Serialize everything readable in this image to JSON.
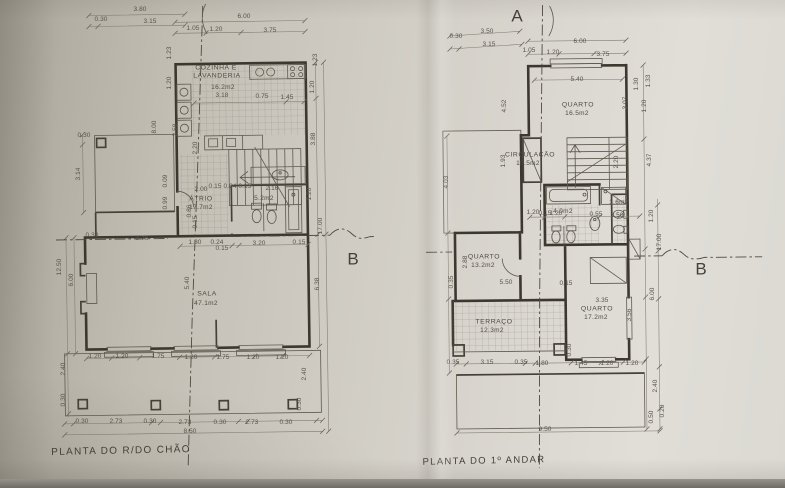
{
  "colors": {
    "paper": "#d3d0c8",
    "ink": "#4a463f"
  },
  "section_markers": [
    {
      "t": "A",
      "x": 517,
      "y": 16,
      "cls": "marker"
    },
    {
      "t": "B",
      "x": 353,
      "y": 259,
      "cls": "marker"
    },
    {
      "t": "B",
      "x": 701,
      "y": 269,
      "cls": "marker"
    }
  ],
  "ground_floor": {
    "title": "PLANTA DO R/DO CHÃO",
    "annotations": [
      {
        "t": "3.80",
        "x": 140,
        "y": 10
      },
      {
        "t": "0.30",
        "x": 101,
        "y": 20
      },
      {
        "t": "3.15",
        "x": 150,
        "y": 22
      },
      {
        "t": "6.00",
        "x": 244,
        "y": 17
      },
      {
        "t": "1.05",
        "x": 193,
        "y": 29
      },
      {
        "t": "1.20",
        "x": 216,
        "y": 30
      },
      {
        "t": "3.75",
        "x": 270,
        "y": 31
      },
      {
        "t": "1.23",
        "x": 170,
        "y": 53,
        "r": -90
      },
      {
        "t": "1.20",
        "x": 170,
        "y": 83,
        "r": -90
      },
      {
        "t": "8.00",
        "x": 155,
        "y": 127,
        "r": -90
      },
      {
        "t": "3.58",
        "x": 176,
        "y": 130,
        "r": -90
      },
      {
        "t": "2.20",
        "x": 196,
        "y": 148,
        "r": -90
      },
      {
        "t": "0.30",
        "x": 84,
        "y": 136
      },
      {
        "t": "3.14",
        "x": 79,
        "y": 174,
        "r": -90
      },
      {
        "t": "0.09",
        "x": 166,
        "y": 181,
        "r": -90
      },
      {
        "t": "0.99",
        "x": 166,
        "y": 203,
        "r": -90
      },
      {
        "t": "12.50",
        "x": 60,
        "y": 267,
        "r": -90
      },
      {
        "t": "6.00",
        "x": 72,
        "y": 280,
        "r": -90
      },
      {
        "t": "0.30",
        "x": 92,
        "y": 236
      },
      {
        "t": "3.76",
        "x": 142,
        "y": 239
      },
      {
        "t": "1.23",
        "x": 316,
        "y": 60,
        "r": -90
      },
      {
        "t": "1.20",
        "x": 313,
        "y": 87,
        "r": -90
      },
      {
        "t": "3.88",
        "x": 314,
        "y": 139,
        "r": -90
      },
      {
        "t": "1.20",
        "x": 310,
        "y": 194,
        "r": -90
      },
      {
        "t": "17.00",
        "x": 321,
        "y": 226,
        "r": -90
      },
      {
        "t": "6.38",
        "x": 318,
        "y": 284,
        "r": -90
      },
      {
        "t": "COZINHA E",
        "x": 216,
        "y": 69,
        "cls": "room"
      },
      {
        "t": "LAVANDERIA",
        "x": 217,
        "y": 77,
        "cls": "room"
      },
      {
        "t": "16.2m2",
        "x": 223,
        "y": 88,
        "cls": "area"
      },
      {
        "t": "3.18",
        "x": 222,
        "y": 96
      },
      {
        "t": "0.75",
        "x": 262,
        "y": 97
      },
      {
        "t": "1.45",
        "x": 287,
        "y": 98
      },
      {
        "t": "2.00",
        "x": 201,
        "y": 190
      },
      {
        "t": "ÁTRIO",
        "x": 201,
        "y": 200,
        "cls": "room"
      },
      {
        "t": "17.7m2",
        "x": 201,
        "y": 208,
        "cls": "area"
      },
      {
        "t": "0.15 0.84 0.15",
        "x": 230,
        "y": 187
      },
      {
        "t": "2.16",
        "x": 272,
        "y": 189
      },
      {
        "t": "5.2m2",
        "x": 264,
        "y": 199,
        "cls": "area"
      },
      {
        "t": "0.86",
        "x": 190,
        "y": 211,
        "r": -90
      },
      {
        "t": "0.15",
        "x": 196,
        "y": 222,
        "r": -90
      },
      {
        "t": "1.80",
        "x": 195,
        "y": 243
      },
      {
        "t": "0.24",
        "x": 217,
        "y": 243
      },
      {
        "t": "0.15",
        "x": 222,
        "y": 249
      },
      {
        "t": "3.20",
        "x": 259,
        "y": 244
      },
      {
        "t": "0.15",
        "x": 299,
        "y": 243
      },
      {
        "t": "5.40",
        "x": 188,
        "y": 283,
        "r": -90
      },
      {
        "t": "SALA",
        "x": 207,
        "y": 295,
        "cls": "room"
      },
      {
        "t": "47.1m2",
        "x": 206,
        "y": 304,
        "cls": "area"
      },
      {
        "t": "1.20",
        "x": 95,
        "y": 357
      },
      {
        "t": "1.20",
        "x": 122,
        "y": 357
      },
      {
        "t": "1.75",
        "x": 158,
        "y": 357
      },
      {
        "t": "1.20",
        "x": 191,
        "y": 358
      },
      {
        "t": "1.75",
        "x": 223,
        "y": 358
      },
      {
        "t": "1.20",
        "x": 253,
        "y": 358
      },
      {
        "t": "1.20",
        "x": 282,
        "y": 358
      },
      {
        "t": "2.40",
        "x": 64,
        "y": 369,
        "r": -90
      },
      {
        "t": "2.40",
        "x": 305,
        "y": 374,
        "r": -90
      },
      {
        "t": "0.30",
        "x": 64,
        "y": 400,
        "r": -90
      },
      {
        "t": "0.30",
        "x": 300,
        "y": 404,
        "r": -90
      },
      {
        "t": "0.30",
        "x": 82,
        "y": 422
      },
      {
        "t": "2.73",
        "x": 116,
        "y": 422
      },
      {
        "t": "0.30",
        "x": 150,
        "y": 422
      },
      {
        "t": "2.73",
        "x": 185,
        "y": 423
      },
      {
        "t": "0.30",
        "x": 220,
        "y": 423
      },
      {
        "t": "2.73",
        "x": 252,
        "y": 423
      },
      {
        "t": "0.30",
        "x": 286,
        "y": 423
      },
      {
        "t": "8.50",
        "x": 190,
        "y": 432
      }
    ]
  },
  "first_floor": {
    "title": "PLANTA DO 1º ANDAR",
    "annotations": [
      {
        "t": "3.50",
        "x": 487,
        "y": 32
      },
      {
        "t": "0.30",
        "x": 456,
        "y": 37
      },
      {
        "t": "3.15",
        "x": 489,
        "y": 45
      },
      {
        "t": "6.00",
        "x": 580,
        "y": 42
      },
      {
        "t": "1.05",
        "x": 529,
        "y": 51
      },
      {
        "t": "1.20",
        "x": 553,
        "y": 53
      },
      {
        "t": "3.75",
        "x": 603,
        "y": 55
      },
      {
        "t": "5.40",
        "x": 577,
        "y": 80
      },
      {
        "t": "1.33",
        "x": 649,
        "y": 81,
        "r": -90
      },
      {
        "t": "1.30",
        "x": 637,
        "y": 84,
        "r": -90
      },
      {
        "t": "4.52",
        "x": 505,
        "y": 106,
        "r": -90
      },
      {
        "t": "QUARTO",
        "x": 578,
        "y": 106,
        "cls": "room"
      },
      {
        "t": "16.5m2",
        "x": 577,
        "y": 114,
        "cls": "area"
      },
      {
        "t": "3.07",
        "x": 626,
        "y": 103,
        "r": -90
      },
      {
        "t": "1.20",
        "x": 645,
        "y": 106,
        "r": -90
      },
      {
        "t": "CIRCULAÇÃO",
        "x": 530,
        "y": 156,
        "cls": "room"
      },
      {
        "t": "10.5m2",
        "x": 528,
        "y": 164,
        "cls": "area"
      },
      {
        "t": "1.93",
        "x": 504,
        "y": 161,
        "r": -90
      },
      {
        "t": "4.03",
        "x": 447,
        "y": 182,
        "r": -90
      },
      {
        "t": "2.20",
        "x": 617,
        "y": 162,
        "r": -90
      },
      {
        "t": "4.37",
        "x": 650,
        "y": 160,
        "r": -90
      },
      {
        "t": "4.0m2",
        "x": 563,
        "y": 212,
        "cls": "area"
      },
      {
        "t": "1.6m2",
        "x": 619,
        "y": 203,
        "cls": "area"
      },
      {
        "t": "1.20",
        "x": 533,
        "y": 213
      },
      {
        "t": "0.15",
        "x": 545,
        "y": 214
      },
      {
        "t": "1.20",
        "x": 556,
        "y": 214
      },
      {
        "t": "0.55",
        "x": 596,
        "y": 215
      },
      {
        "t": "1.50",
        "x": 617,
        "y": 216
      },
      {
        "t": "QUARTO",
        "x": 484,
        "y": 258,
        "cls": "room"
      },
      {
        "t": "13.2m2",
        "x": 483,
        "y": 266,
        "cls": "area"
      },
      {
        "t": "2.88",
        "x": 466,
        "y": 262,
        "r": -90
      },
      {
        "t": "0.35",
        "x": 452,
        "y": 282,
        "r": -90
      },
      {
        "t": "5.50",
        "x": 506,
        "y": 283
      },
      {
        "t": "0.15",
        "x": 566,
        "y": 284
      },
      {
        "t": "3.35",
        "x": 602,
        "y": 301
      },
      {
        "t": "QUARTO",
        "x": 597,
        "y": 310,
        "cls": "room"
      },
      {
        "t": "17.2m2",
        "x": 596,
        "y": 318,
        "cls": "area"
      },
      {
        "t": "3.56",
        "x": 630,
        "y": 315,
        "r": -90
      },
      {
        "t": "TERRAÇO",
        "x": 494,
        "y": 323,
        "cls": "room"
      },
      {
        "t": "12.3m2",
        "x": 492,
        "y": 331,
        "cls": "area"
      },
      {
        "t": "0.30",
        "x": 570,
        "y": 350,
        "r": -90
      },
      {
        "t": "1.20",
        "x": 652,
        "y": 216,
        "r": -90
      },
      {
        "t": "17.00",
        "x": 660,
        "y": 242,
        "r": -90
      },
      {
        "t": "6.00",
        "x": 653,
        "y": 294,
        "r": -90
      },
      {
        "t": "2.40",
        "x": 656,
        "y": 386,
        "r": -90
      },
      {
        "t": "0.50",
        "x": 652,
        "y": 417,
        "r": -90
      },
      {
        "t": "0.20",
        "x": 663,
        "y": 411,
        "r": -90
      },
      {
        "t": "0.35",
        "x": 453,
        "y": 363
      },
      {
        "t": "3.15",
        "x": 487,
        "y": 363
      },
      {
        "t": "0.35",
        "x": 521,
        "y": 363
      },
      {
        "t": "1.80",
        "x": 542,
        "y": 364
      },
      {
        "t": "1.45",
        "x": 581,
        "y": 364
      },
      {
        "t": "1.20",
        "x": 607,
        "y": 364
      },
      {
        "t": "1.20",
        "x": 632,
        "y": 364
      },
      {
        "t": "9.50",
        "x": 545,
        "y": 430
      }
    ]
  }
}
